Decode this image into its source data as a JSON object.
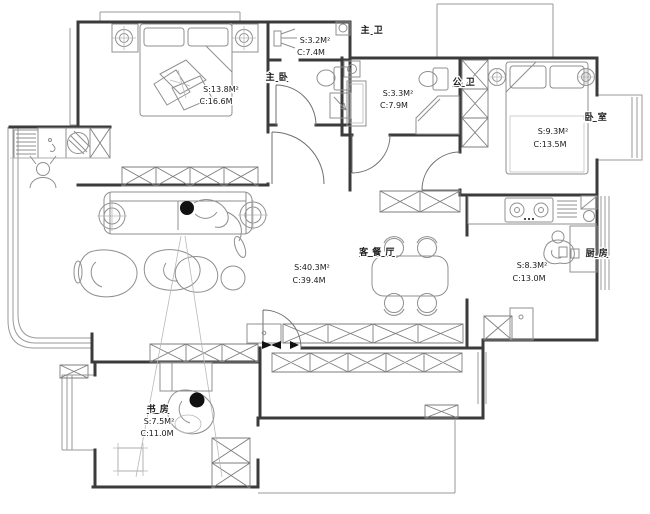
{
  "plan": {
    "type": "apartment-floor-plan",
    "rooms": {
      "master_bathroom": {
        "name": "主 卫",
        "area": "S:3.2M²",
        "circulation": "C:7.4M"
      },
      "master_bedroom": {
        "name": "主 卧",
        "area": "S:13.8M²",
        "circulation": "C:16.6M"
      },
      "public_bathroom": {
        "name": "公 卫",
        "area": "S:3.3M²",
        "circulation": "C:7.9M"
      },
      "bedroom": {
        "name": "卧 室",
        "area": "S:9.3M²",
        "circulation": "C:13.5M"
      },
      "living_dining": {
        "name": "客 餐 厅",
        "area": "S:40.3M²",
        "circulation": "C:39.4M"
      },
      "kitchen": {
        "name": "厨 房",
        "area": "S:8.3M²",
        "circulation": "C:13.0M"
      },
      "study": {
        "name": "书 房",
        "area": "S:7.5M²",
        "circulation": "C:11.0M"
      }
    },
    "colors": {
      "wall": "#3b3b3b",
      "furniture": "#8f8f8f",
      "hatch": "#7d7d7d",
      "text": "#1a1a1a",
      "background": "#ffffff",
      "figure_head": "#111111"
    }
  }
}
